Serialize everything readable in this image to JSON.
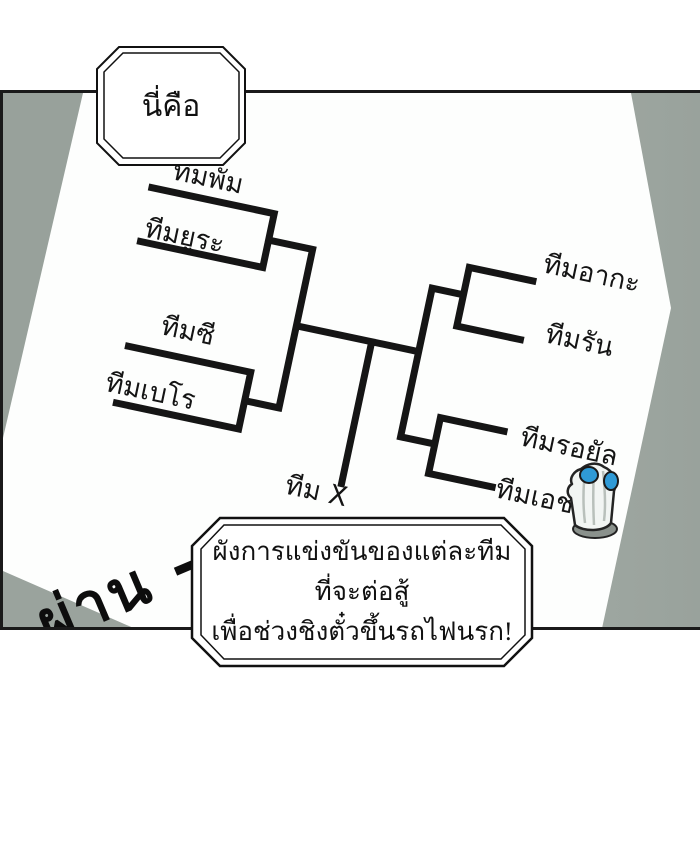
{
  "speech_bubble": {
    "text": "นี่คือ"
  },
  "bracket": {
    "left_teams": [
      {
        "label": "ทีมพัม"
      },
      {
        "label": "ทีมยูระ"
      },
      {
        "label": "ทีมซี"
      },
      {
        "label": "ทีมเบโร"
      }
    ],
    "right_teams": [
      {
        "label": "ทีมอากะ"
      },
      {
        "label": "ทีมรัน"
      },
      {
        "label": "ทีมรอยัล"
      },
      {
        "label": "ทีมเอช"
      }
    ],
    "center_team": "ทีม X",
    "pairings": [
      [
        "ทีมพัม",
        "ทีมยูระ"
      ],
      [
        "ทีมซี",
        "ทีมเบโร"
      ],
      [
        "ทีมอากะ",
        "ทีมรัน"
      ],
      [
        "ทีมรอยัล",
        "ทีมเอช"
      ]
    ]
  },
  "annotations": {
    "handwritten": "ผ่าน -"
  },
  "caption": {
    "lines": [
      "ผังการแข่งขันของแต่ละทีม",
      "ที่จะต่อสู้",
      "เพื่อช่วงชิงตั๋วขึ้นรถไฟนรก!"
    ]
  },
  "colors": {
    "line": "#151515",
    "panel_shade_dark": "#98a19b",
    "panel_shade_light": "#cfd6d1",
    "ghost_eye": "#2f9ad6",
    "paper": "#fdfefd"
  }
}
